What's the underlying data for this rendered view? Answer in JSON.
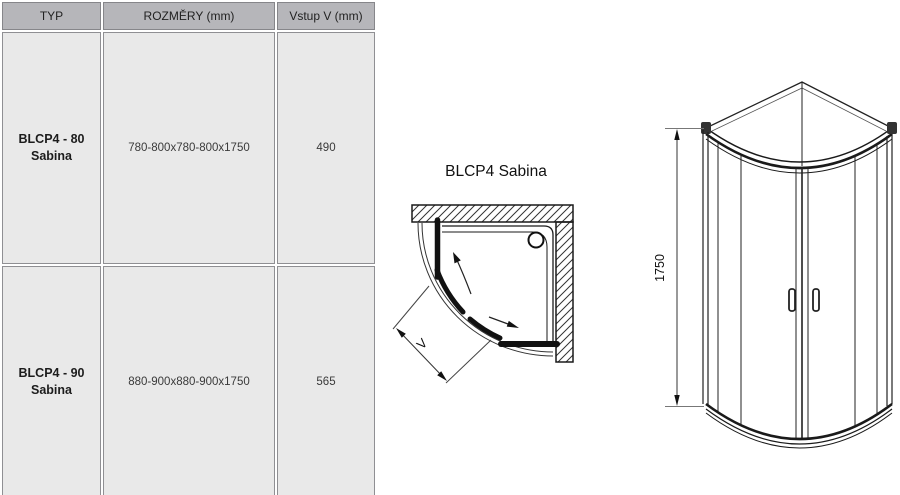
{
  "table": {
    "headers": [
      "TYP",
      "ROZMĚRY (mm)",
      "Vstup V (mm)"
    ],
    "rows": [
      {
        "type_line1": "BLCP4 - 80",
        "type_line2": "Sabina",
        "dimensions": "780-800x780-800x1750",
        "entry": "490"
      },
      {
        "type_line1": "BLCP4 - 90",
        "type_line2": "Sabina",
        "dimensions": "880-900x880-900x1750",
        "entry": "565"
      }
    ]
  },
  "plan_view": {
    "title": "BLCP4 Sabina",
    "entry_dim_label": "V"
  },
  "front_view": {
    "height_dim_label": "1750"
  },
  "colors": {
    "header_bg": "#b6b6ba",
    "row_bg": "#e9e9e9",
    "cell_border": "#8f8f93",
    "line": "#1a1a1a"
  }
}
